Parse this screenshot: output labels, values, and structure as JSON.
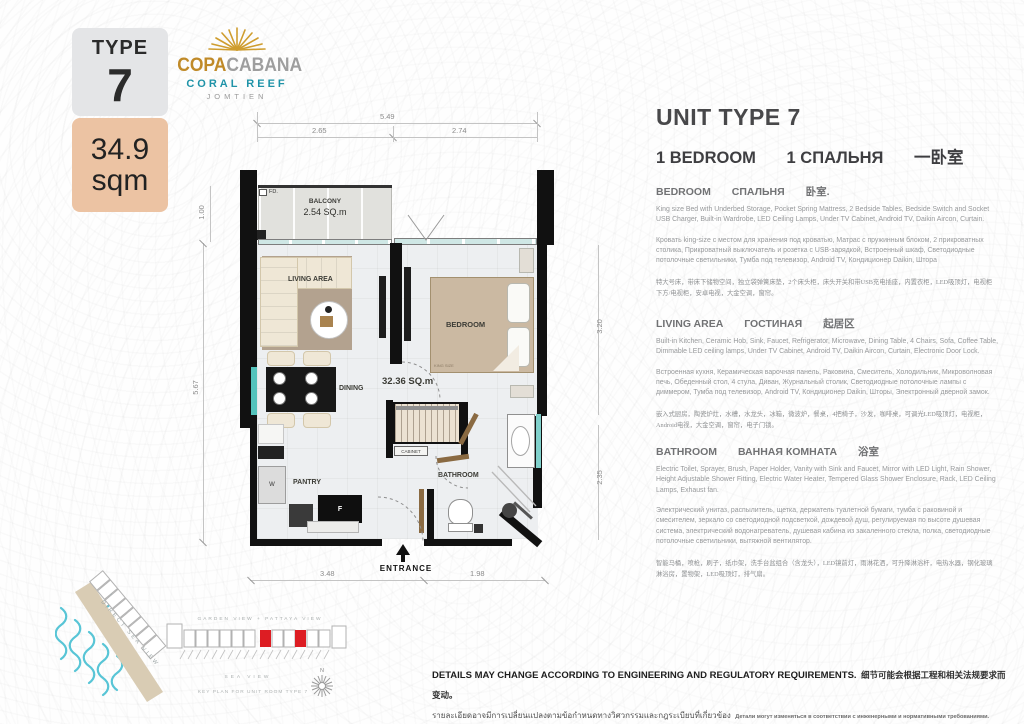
{
  "badge": {
    "type_label": "TYPE",
    "type_number": "7",
    "area_value": "34.9",
    "area_unit": "sqm"
  },
  "logo": {
    "name_gold": "COPA",
    "name_silver": "CABANA",
    "line2": "CORAL REEF",
    "line3": "JOMTIEN"
  },
  "colors": {
    "badge_peach": "#ecc3a3",
    "logo_gold": "#c08a28",
    "logo_teal": "#1f93a8",
    "keyplan_red": "#dd1d23",
    "wave_teal": "#58c5d6"
  },
  "floorplan": {
    "dims": {
      "top_total": "5.49",
      "top_left": "2.65",
      "top_right": "2.74",
      "left_balcony": "1.00",
      "left_main": "5.67",
      "right_bedroom": "3.20",
      "right_bathroom": "2.35",
      "bottom_left": "3.48",
      "bottom_right": "1.98"
    },
    "labels": {
      "fd": "FD.",
      "balcony_name": "BALCONY",
      "balcony_area": "2.54 SQ.m",
      "living": "LIVING AREA",
      "bedroom": "BEDROOM",
      "bed_size": "KING SIZE",
      "dining": "DINING",
      "unit_area": "32.36 SQ.m",
      "pantry": "PANTRY",
      "washer": "W",
      "fridge": "F",
      "cabinet": "CABINET",
      "bathroom": "BATHROOM",
      "entrance": "ENTRANCE"
    }
  },
  "keyplan": {
    "direct_sea_view": "DIRECT SEA VIEW",
    "garden_view": "GARDEN VIEW + PATTAYA VIEW",
    "sea_view": "SEA VIEW",
    "caption": "KEY PLAN FOR UNIT ROOM TYPE 7",
    "compass_n": "N"
  },
  "info": {
    "title": "UNIT TYPE 7",
    "subtitle": {
      "en": "1 BEDROOM",
      "ru": "1 СПАЛЬНЯ",
      "zh": "一卧室"
    },
    "sections": [
      {
        "heading": {
          "en": "BEDROOM",
          "ru": "СПАЛЬНЯ",
          "zh": "卧室."
        },
        "en": "King size Bed with Underbed Storage, Pocket Spring Mattress, 2 Bedside Tables, Bedside Switch and Socket USB Charger, Built-in Wardrobe, LED Ceiling Lamps, Under TV Cabinet, Android TV, Daikin Aircon, Curtain.",
        "ru": "Кровать king-size с местом для хранения под кроватью, Матрас с пружинным блоком, 2 прикроватных столика, Прикроватный выключатель и розетка с USB-зарядкой, Встроенный шкаф, Светодиодные потолочные светильники, Тумба под телевизор, Android TV, Кондиционер Daikin, Штора",
        "zh": "特大号床，带床下储物空间，独立袋弹簧床垫，2个床头柜，床头开关和带USB充电插座，内置衣柜，LED吸顶灯，电视柜下方/电视柜，安卓电视，大金空调，窗帘。"
      },
      {
        "heading": {
          "en": "LIVING AREA",
          "ru": "ГОСТИНАЯ",
          "zh": "起居区"
        },
        "en": "Built-in Kitchen, Ceramic Hob, Sink, Faucet, Refrigerator, Microwave, Dining Table, 4 Chairs, Sofa, Coffee Table, Dimmable LED ceiling lamps, Under TV Cabinet, Android TV, Daikin Aircon, Curtain, Electronic Door Lock.",
        "ru": "Встроенная кухня, Керамическая варочная панель, Раковина, Смеситель, Холодильник, Микроволновая печь, Обеденный стол, 4 стула, Диван, Журнальный столик, Светодиодные потолочные лампы с диммером, Тумба под телевизор, Android TV, Кондиционер Daikin, Шторы, Электронный дверной замок.",
        "zh": "嵌入式厨房，陶瓷炉灶，水槽，水龙头，冰箱，微波炉，餐桌，4把椅子，沙发，咖啡桌，可调光LED吸顶灯，电视柜，Android电视，大金空调，窗帘，电子门锁。"
      },
      {
        "heading": {
          "en": "BATHROOM",
          "ru": "ВАННАЯ КОМНАТА",
          "zh": "浴室"
        },
        "en": "Electric Toilet, Sprayer, Brush, Paper Holder, Vanity with Sink and Faucet, Mirror with LED Light, Rain Shower, Height Adjustable Shower Fitting, Electric Water Heater, Tempered Glass Shower Enclosure, Rack, LED Ceiling Lamps, Exhaust fan.",
        "ru": "Электрический унитаз, распылитель, щетка, держатель туалетной бумаги, тумба с раковиной и смесителем, зеркало со светодиодной подсветкой, дождевой душ, регулируемая по высоте душевая система, электрический водонагреватель, душевая кабина из закаленного стекла, полка, светодиодные потолочные светильники, вытяжной вентилятор.",
        "zh": "智能马桶，喷枪，刷子，纸巾架，洗手台盆组合（含龙头），LED镜前灯，雨淋花洒，可升降淋浴杆，电热水器，钢化玻璃淋浴房，置物架，LED吸顶灯，排气扇。"
      }
    ]
  },
  "disclaimer": {
    "line1_en": "DETAILS MAY CHANGE ACCORDING TO ENGINEERING AND REGULATORY REQUIREMENTS.",
    "line1_zh": "细节可能会根据工程和相关法规要求而变动。",
    "line2_th": "รายละเอียดอาจมีการเปลี่ยนแปลงตามข้อกำหนดทางวิศวกรรมและกฎระเบียบที่เกี่ยวข้อง",
    "line2_ru": "Детали могут изменяться в соответствии с инженерными и нормативными требованиями."
  }
}
